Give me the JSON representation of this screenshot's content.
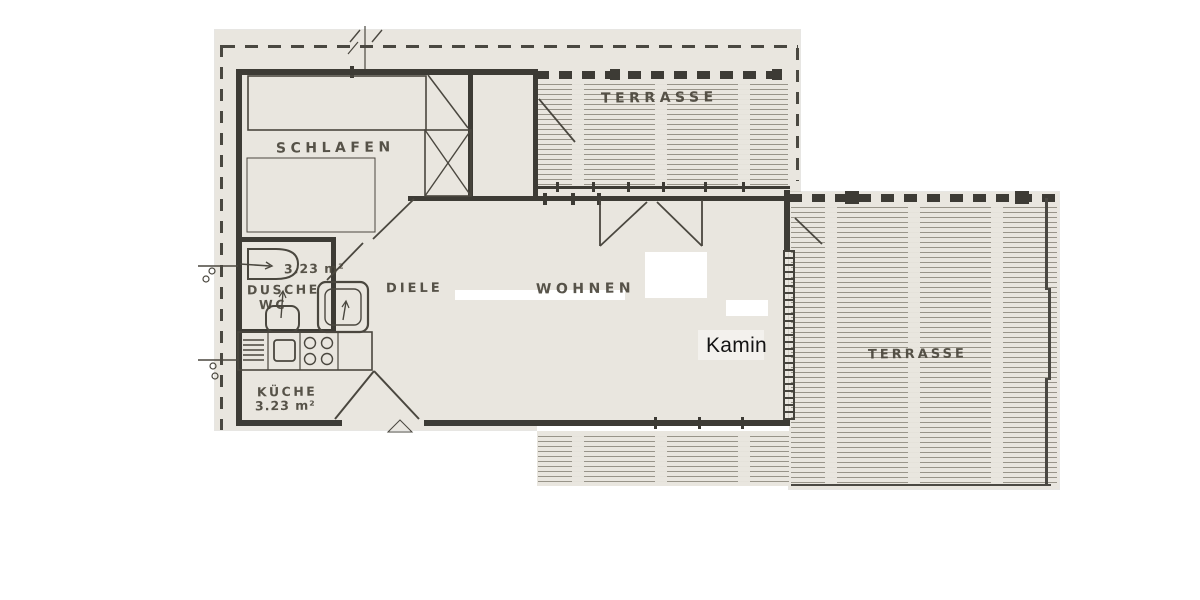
{
  "plan": {
    "labels": {
      "schlafen": "SCHLAFEN",
      "terrasse_top": "TERRASSE",
      "bath_area": "3.23 m²",
      "dusche": "DUSCHE",
      "wc": "WC",
      "diele": "DIELE",
      "wohnen": "WOHNEN",
      "kamin": "Kamin",
      "kueche": "KÜCHE",
      "kueche_area": "3.23 m²",
      "terrasse_right": "TERRASSE"
    },
    "colors": {
      "paper": "#e9e6df",
      "wall_ink": "#3d3b35",
      "hand_text": "#4a463c",
      "annotation_text": "#141414",
      "hatch_line": "#56504a"
    },
    "fixtures": [
      "bed",
      "closet",
      "washbasin",
      "shower",
      "wc",
      "kitchen-counter",
      "sink",
      "stove",
      "entrance-door",
      "door-swings",
      "sliding-window",
      "terrace-railing"
    ]
  }
}
